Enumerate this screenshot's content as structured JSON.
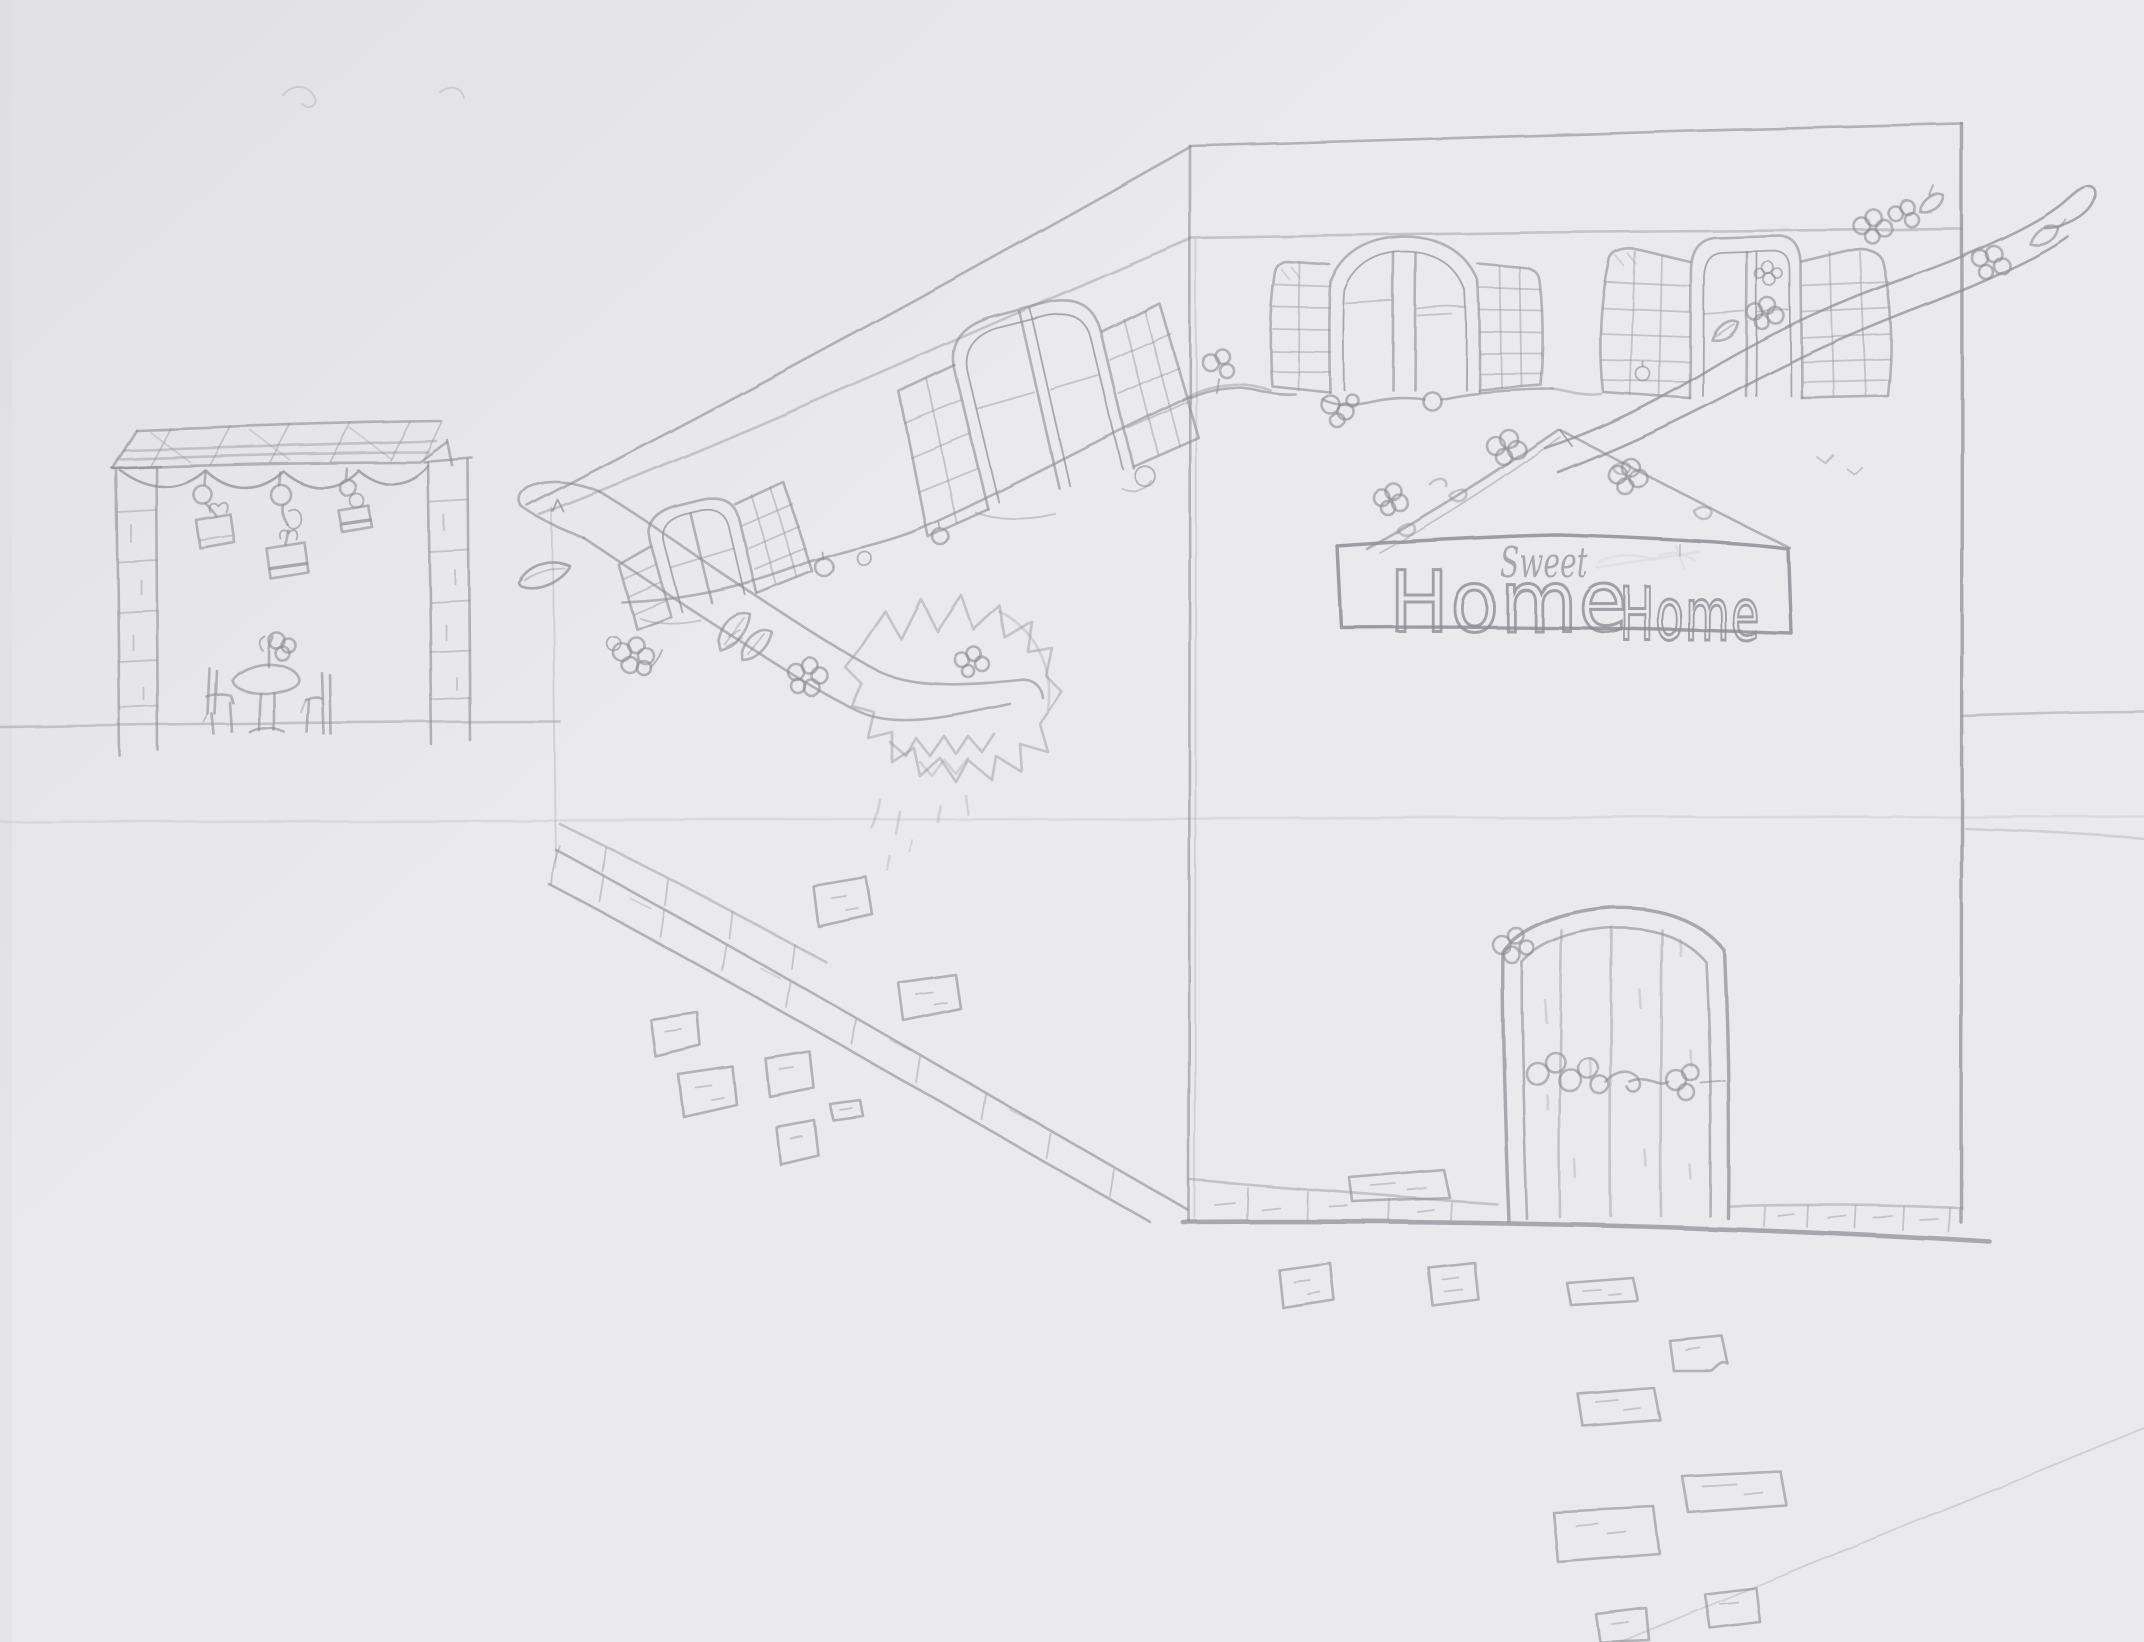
{
  "colors": {
    "paper": "#eaeaed",
    "pencil": "#8e8e95",
    "shadow": "#dfdfe4",
    "shadow_deep": "#d9d9de"
  },
  "sign": {
    "word_small": "Sweet",
    "word_left": "Home",
    "word_right": "Home"
  },
  "objects": {
    "scene": "pencil sketch on paper of a street-side house in perspective",
    "house_front": "front wall of house with two shuttered arched windows, hanging sign and wooden door",
    "side_wall": "perspective side wall with two shuttered windows, string lights and brick curb",
    "sign": "hanging banner reading Home Sweet Home under a flowered gable",
    "door": "arched plank door decorated with a flower garland",
    "pergola": "brick-pillared pergola with lattice roof, hanging pots, table and chairs",
    "branch": "long blossoming branch crossing the scene",
    "bush": "spiky shrub over the branch",
    "stones": "scattered paving stones and brick path"
  }
}
